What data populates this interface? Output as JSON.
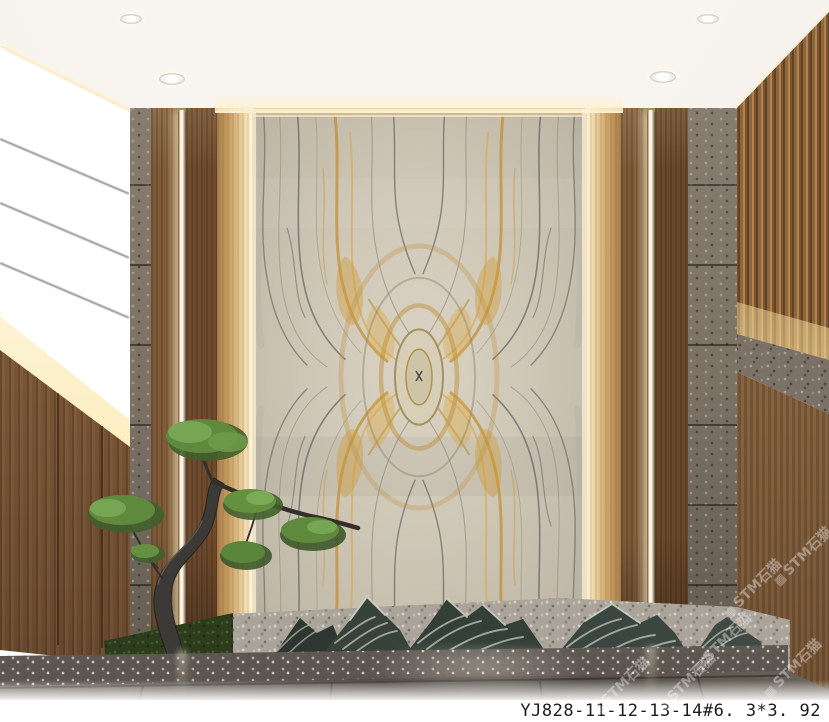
{
  "image": {
    "alt": "Interior lobby render: backlit book-matched golden-vein marble feature wall flanked by wood panels, LED light strips and stone pilasters, with a bonsai pine over a moss bed, striped mountain-shaped landscape rocks on gravel, and a dark polished stone floor"
  },
  "caption": {
    "text": "YJ828-11-12-13-14#6. 3*3. 92"
  },
  "watermark": {
    "icon_char": "▦",
    "text": "STM石猫"
  },
  "palette": {
    "ceiling": "#f2efe8",
    "marble_base": "#c9c2b2",
    "marble_gold_vein": "#c9962f",
    "marble_grey_vein": "#6e7272",
    "wood_panel": "#7a5636",
    "wood_slats": "#8f663c",
    "stone_pilaster": "#7b7165",
    "left_wall_stone": "#8a7c69",
    "cove_light": "#fceec6",
    "led_strip": "#fffdf4",
    "foliage_green": "#62903f",
    "trunk": "#3b3a36",
    "rock": "#39443c",
    "rock_stripe": "#bcc2b4",
    "gravel": "#aaa49a",
    "moss": "#2c3c1d",
    "granite_curb": "#8a847b",
    "floor_tile": "#575049"
  }
}
